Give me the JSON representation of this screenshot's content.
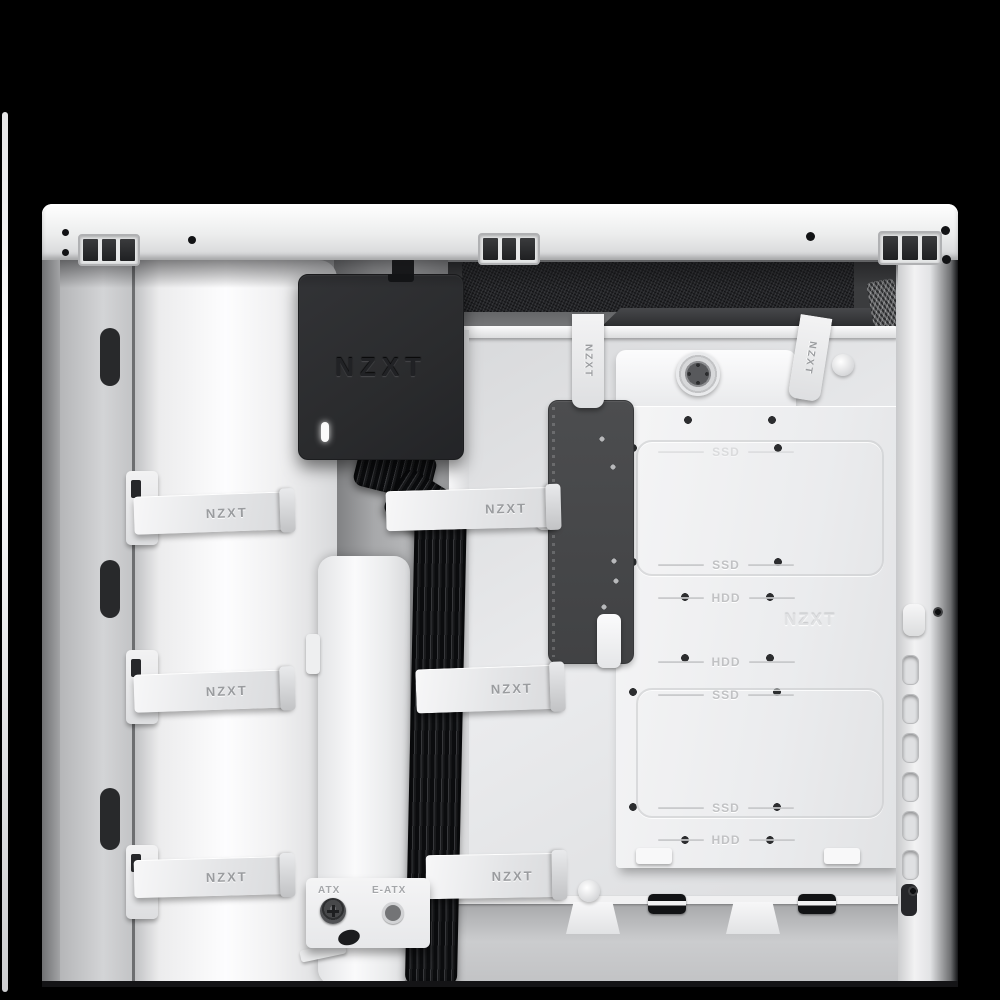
{
  "brand_wordmark": "NZXT",
  "colors": {
    "background": "#000000",
    "case_body": "#eef0f1",
    "controller_body": "#2b2c2e",
    "cable_black": "#121315",
    "embossed_label_gray": "#c1c2c4",
    "strap_text_gray": "#9a9c9f"
  },
  "controller": {
    "logo": "NZXT"
  },
  "straps": {
    "label": "NZXT"
  },
  "drive_cage": {
    "embossed_logo": "NZXT",
    "slot_labels": [
      "SSD",
      "SSD",
      "HDD",
      "HDD",
      "SSD",
      "SSD",
      "HDD"
    ]
  },
  "standoffs": {
    "atx": "ATX",
    "eatx": "E-ATX"
  }
}
